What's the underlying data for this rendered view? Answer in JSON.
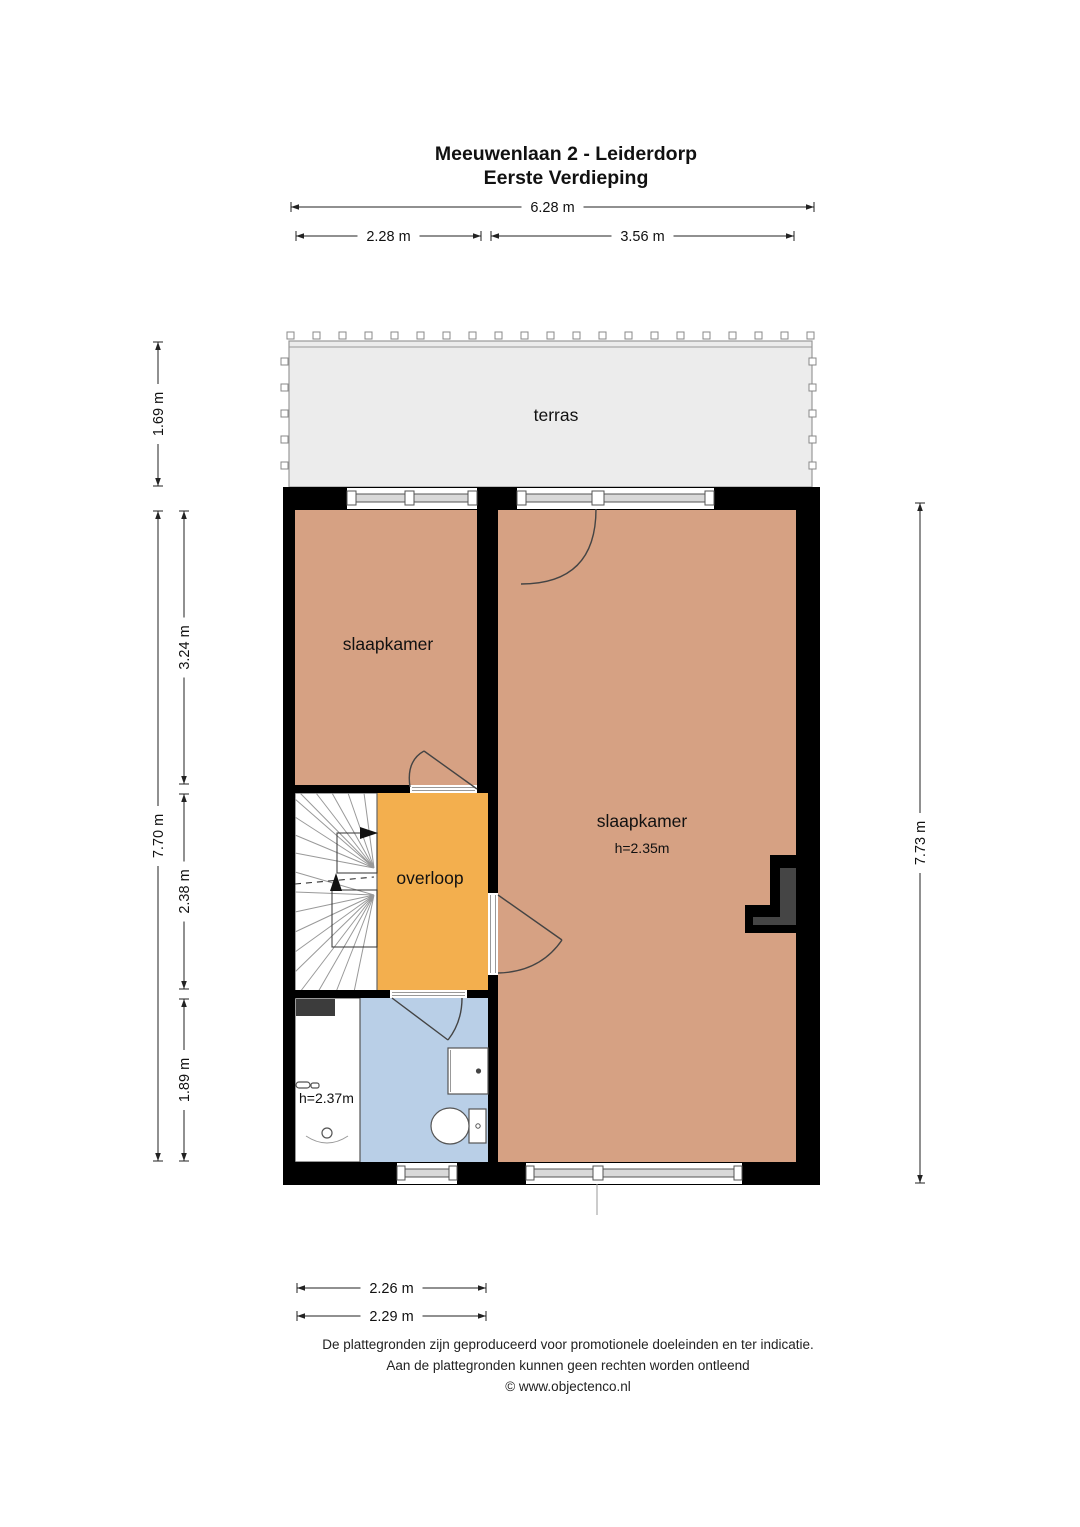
{
  "title": {
    "line1": "Meeuwenlaan 2 - Leiderdorp",
    "line2": "Eerste Verdieping"
  },
  "rooms": {
    "terrace_label": "terras",
    "bedroom_left_label": "slaapkamer",
    "bedroom_right_label": "slaapkamer",
    "bedroom_right_height": "h=2.35m",
    "landing_label": "overloop",
    "bathroom_height": "h=2.37m"
  },
  "dimensions": {
    "top_total": "6.28 m",
    "top_left": "2.28 m",
    "top_right": "3.56 m",
    "left_terrace": "1.69 m",
    "left_total": "7.70 m",
    "left_upper": "3.24 m",
    "left_middle": "2.38 m",
    "left_lower": "1.89 m",
    "right_total": "7.73 m",
    "bottom_inner": "2.26 m",
    "bottom_outer": "2.29 m"
  },
  "footer": {
    "line1": "De plattegronden zijn geproduceerd voor promotionele doeleinden en ter indicatie.",
    "line2": "Aan de plattegronden kunnen geen rechten worden ontleend",
    "line3": "© www.objectenco.nl"
  },
  "colors": {
    "floor_bedroom": "#d6a183",
    "floor_landing": "#f3af4e",
    "floor_bathroom": "#b9cfe7",
    "floor_terrace": "#ececec",
    "wall": "#000000"
  }
}
